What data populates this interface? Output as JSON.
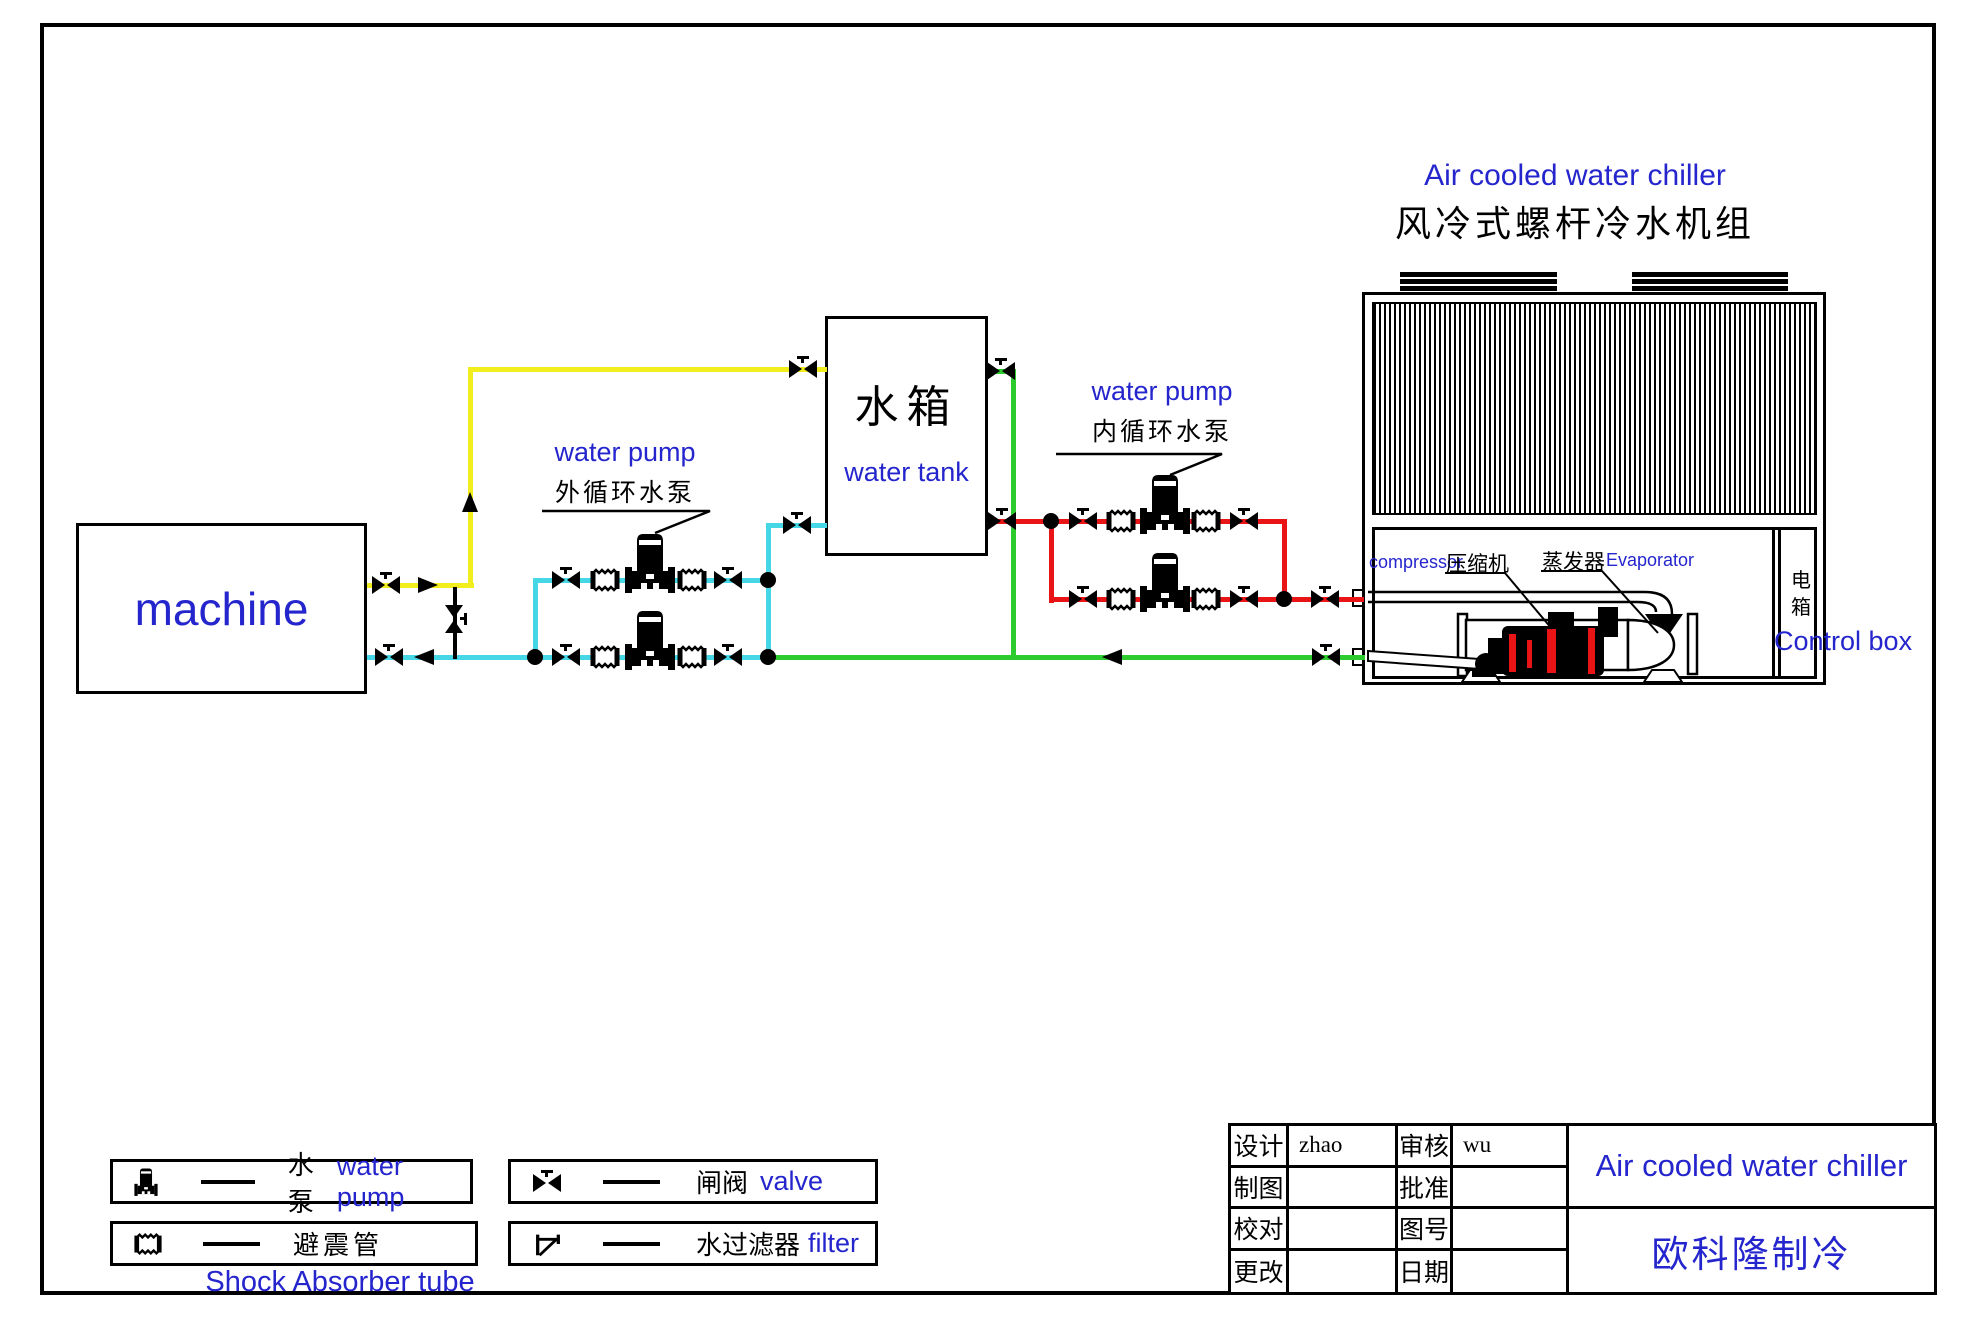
{
  "page": {
    "titles": {
      "main_en": "Air cooled water chiller",
      "main_zh": "风冷式螺杆冷水机组"
    },
    "colors": {
      "blue_text": "#2525cd",
      "pipe_yellow": "#f2ee1e",
      "pipe_cyan": "#45d7e6",
      "pipe_green": "#2ecb2e",
      "pipe_red": "#e81416",
      "line_black": "#000000"
    }
  },
  "machine": {
    "label": "machine"
  },
  "water_tank": {
    "label_zh": "水箱",
    "label_en": "water tank"
  },
  "external_pump": {
    "label_en": "water pump",
    "label_zh": "外循环水泵"
  },
  "internal_pump": {
    "label_en": "water pump",
    "label_zh": "内循环水泵"
  },
  "chiller": {
    "compressor_en": "compressor",
    "compressor_zh": "压缩机",
    "evaporator_zh": "蒸发器",
    "evaporator_en": "Evaporator",
    "control_box_zh": "电箱",
    "control_box_en": "Control box"
  },
  "legend": {
    "items": [
      {
        "symbol": "pump-icon",
        "zh": "水泵",
        "en": "water pump"
      },
      {
        "symbol": "shock-absorber-icon",
        "zh": "避震管",
        "en": "Shock Absorber tube"
      },
      {
        "symbol": "valve-icon",
        "zh": "闸阀",
        "en": "valve"
      },
      {
        "symbol": "filter-icon",
        "zh": "水过滤器",
        "en": "filter"
      }
    ]
  },
  "title_block": {
    "rows": [
      {
        "label": "设计",
        "value": "zhao",
        "label2": "审核",
        "value2": "wu"
      },
      {
        "label": "制图",
        "value": "",
        "label2": "批准",
        "value2": ""
      },
      {
        "label": "校对",
        "value": "",
        "label2": "图号",
        "value2": ""
      },
      {
        "label": "更改",
        "value": "",
        "label2": "日期",
        "value2": ""
      }
    ],
    "product": "Air cooled water chiller",
    "company": "欧科隆制冷"
  }
}
